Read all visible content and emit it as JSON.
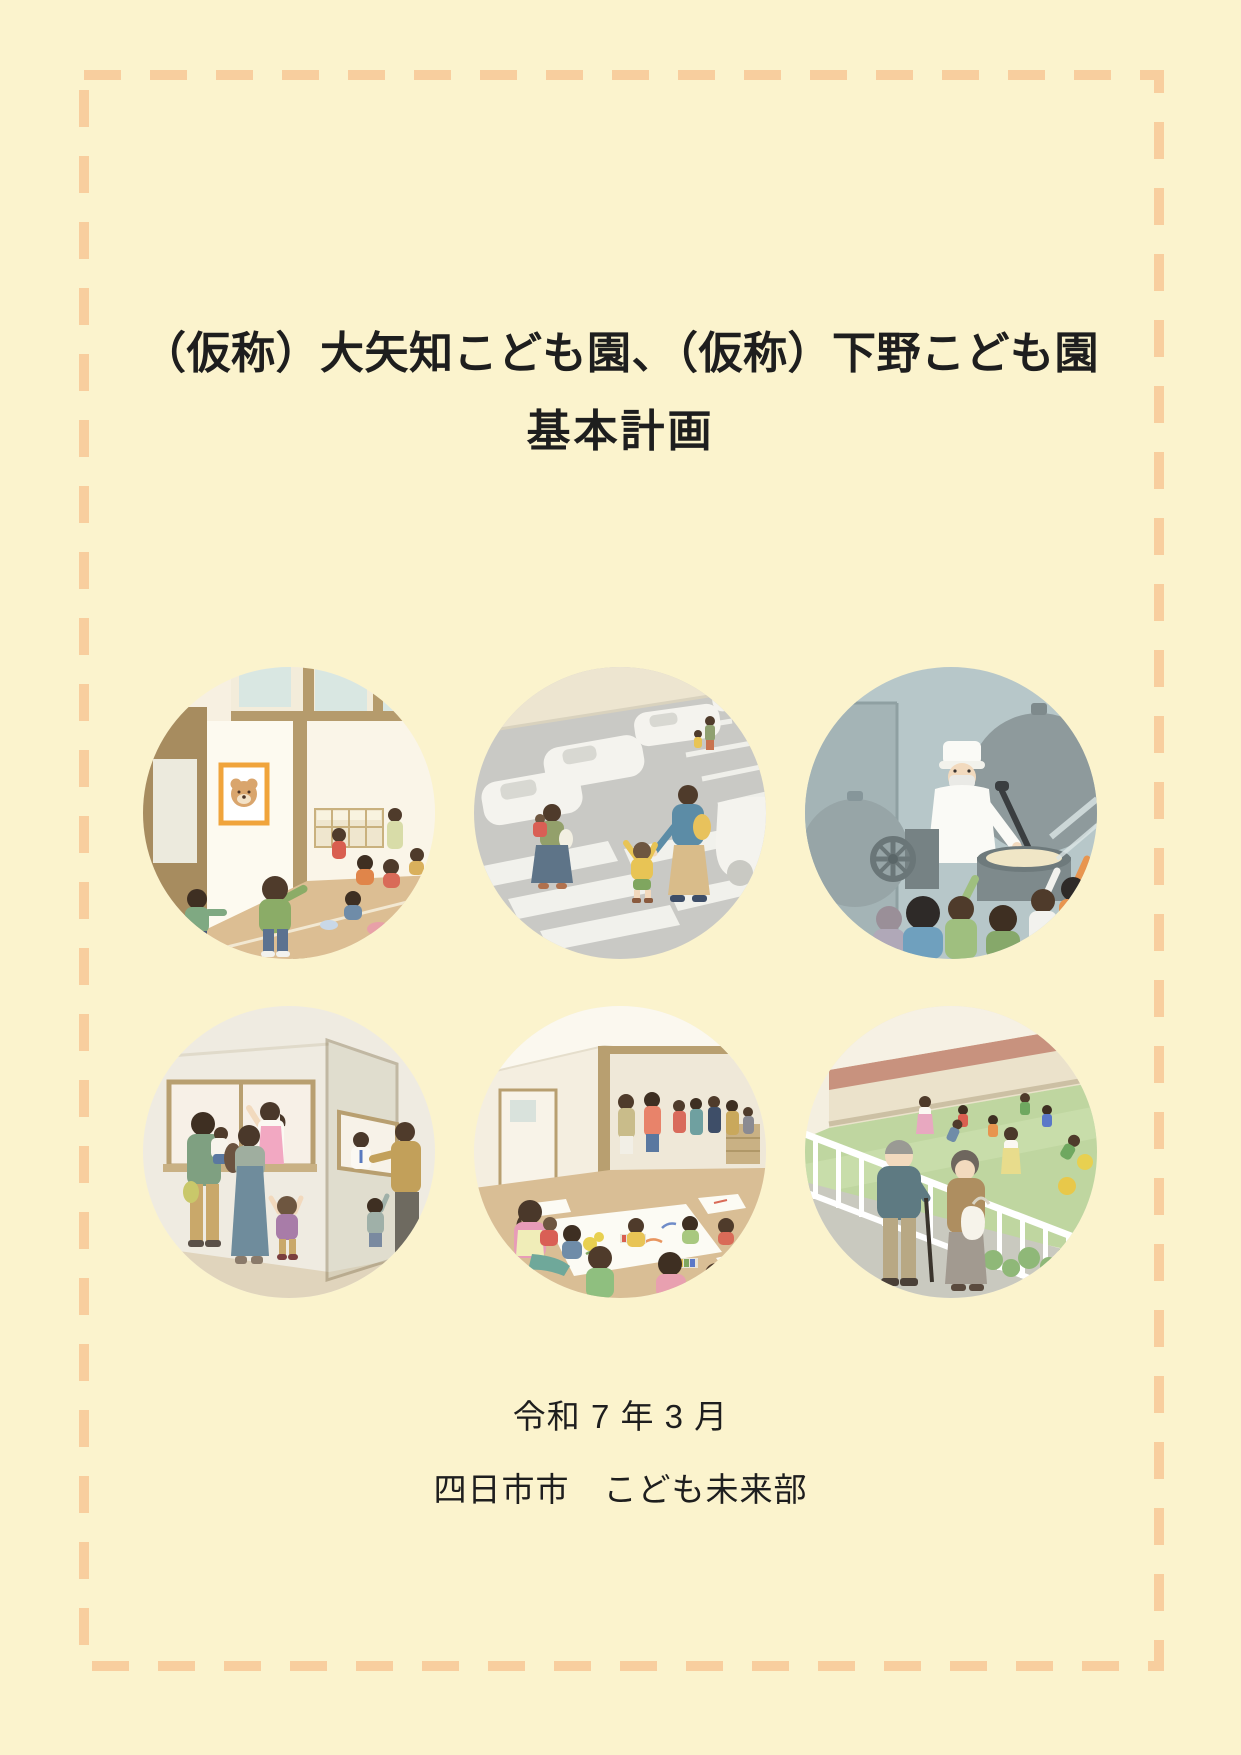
{
  "page": {
    "background_color": "#FBF3CD",
    "border_color": "#F8CE9E",
    "text_color": "#1E1E1E"
  },
  "title": {
    "line1": "（仮称）大矢知こども園、（仮称）下野こども園",
    "line2": "基本計画"
  },
  "footer": {
    "date": "令和 7 年 3 月",
    "organization": "四日市市　こども未来部"
  },
  "illustrations": [
    {
      "id": "classroom-entrance",
      "label": "Children playing at the nursery room entrance with a bear picture on the wall"
    },
    {
      "id": "parking-crosswalk",
      "label": "Parents and children crossing a crosswalk in the parking lot"
    },
    {
      "id": "school-kitchen",
      "label": "Cook stirring a large pot in the school kitchen while children watch"
    },
    {
      "id": "reception-window",
      "label": "Family talking with staff at the reception window"
    },
    {
      "id": "playroom-drawing",
      "label": "Children drawing on large sheets of paper while parents watch"
    },
    {
      "id": "schoolyard-fence",
      "label": "Elderly couple watching children play in the schoolyard from behind a white fence"
    }
  ]
}
